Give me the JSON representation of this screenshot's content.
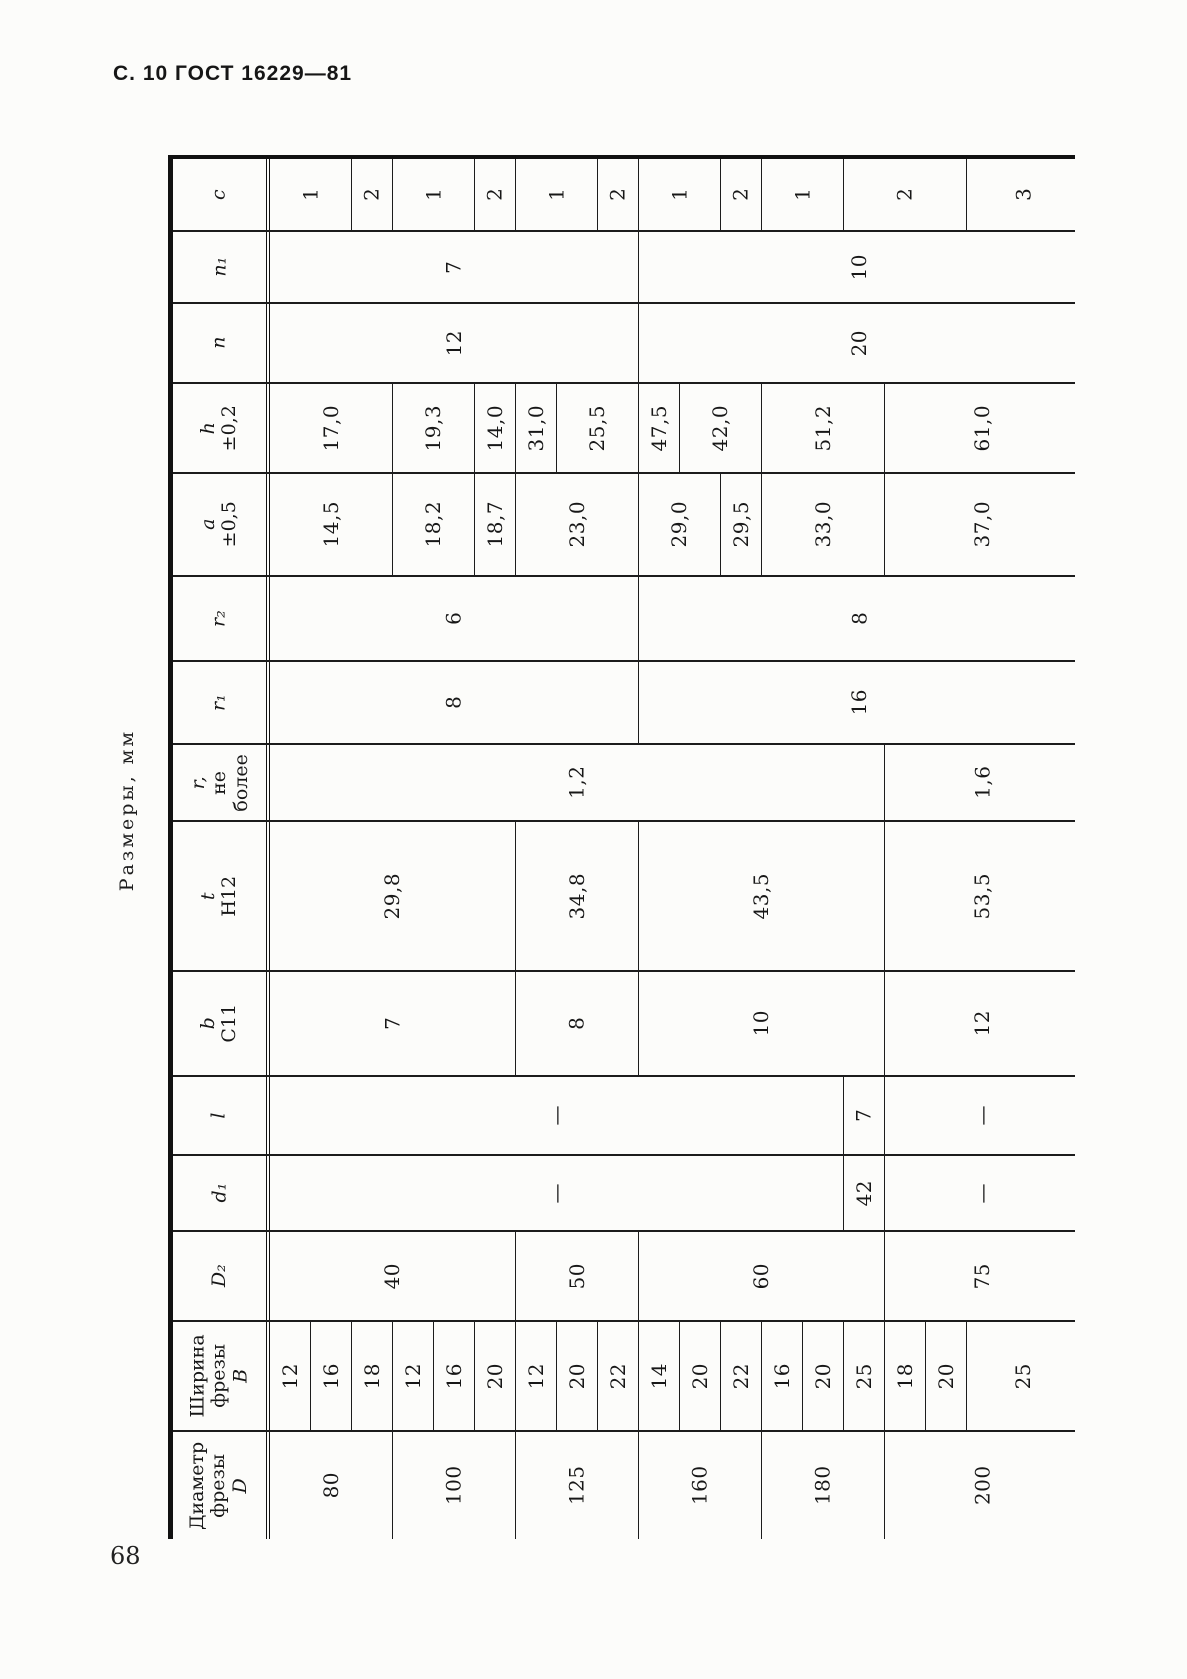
{
  "page": {
    "header": "С. 10 ГОСТ 16229—81",
    "page_number": "68",
    "table_caption": "Размеры, мм"
  },
  "table": {
    "columns": 18,
    "col_width": 41,
    "last_col_width": 113,
    "rows": [
      {
        "id": "c",
        "h": 73,
        "label": [
          {
            "t": "c",
            "i": true
          }
        ],
        "cells": [
          {
            "s": 2,
            "v": "1"
          },
          {
            "s": 1,
            "v": "2"
          },
          {
            "s": 2,
            "v": "1"
          },
          {
            "s": 1,
            "v": "2"
          },
          {
            "s": 2,
            "v": "1"
          },
          {
            "s": 1,
            "v": "2"
          },
          {
            "s": 2,
            "v": "1"
          },
          {
            "s": 1,
            "v": "2"
          },
          {
            "s": 2,
            "v": "1"
          },
          {
            "s": 3,
            "v": "2"
          },
          {
            "s": 1,
            "v": "3"
          }
        ]
      },
      {
        "id": "n1",
        "h": 72,
        "label": [
          {
            "t": "n₁",
            "i": true
          }
        ],
        "cells": [
          {
            "s": 9,
            "v": "7"
          },
          {
            "s": 9,
            "v": "10"
          }
        ]
      },
      {
        "id": "n",
        "h": 80,
        "label": [
          {
            "t": "n",
            "i": true
          }
        ],
        "cells": [
          {
            "s": 9,
            "v": "12"
          },
          {
            "s": 9,
            "v": "20"
          }
        ]
      },
      {
        "id": "h",
        "h": 90,
        "label": [
          {
            "t": "h",
            "i": true
          },
          {
            "t": "±0,2"
          }
        ],
        "cells": [
          {
            "s": 3,
            "v": "17,0"
          },
          {
            "s": 2,
            "v": "19,3"
          },
          {
            "s": 1,
            "v": "14,0"
          },
          {
            "s": 1,
            "v": "31,0"
          },
          {
            "s": 2,
            "v": "25,5"
          },
          {
            "s": 1,
            "v": "47,5"
          },
          {
            "s": 2,
            "v": "42,0"
          },
          {
            "s": 3,
            "v": "51,2"
          },
          {
            "s": 3,
            "v": "61,0"
          }
        ]
      },
      {
        "id": "a",
        "h": 103,
        "label": [
          {
            "t": "a",
            "i": true
          },
          {
            "t": "±0,5"
          }
        ],
        "cells": [
          {
            "s": 3,
            "v": "14,5"
          },
          {
            "s": 2,
            "v": "18,2"
          },
          {
            "s": 1,
            "v": "18,7"
          },
          {
            "s": 3,
            "v": "23,0"
          },
          {
            "s": 2,
            "v": "29,0"
          },
          {
            "s": 1,
            "v": "29,5"
          },
          {
            "s": 3,
            "v": "33,0"
          },
          {
            "s": 3,
            "v": "37,0"
          }
        ]
      },
      {
        "id": "r2",
        "h": 85,
        "label": [
          {
            "t": "r₂",
            "i": true
          }
        ],
        "cells": [
          {
            "s": 9,
            "v": "6"
          },
          {
            "s": 9,
            "v": "8"
          }
        ]
      },
      {
        "id": "r1",
        "h": 83,
        "label": [
          {
            "t": "r₁",
            "i": true
          }
        ],
        "cells": [
          {
            "s": 9,
            "v": "8"
          },
          {
            "s": 9,
            "v": "16"
          }
        ]
      },
      {
        "id": "r",
        "h": 77,
        "label": [
          {
            "t": "r,",
            "i": true
          },
          {
            "t": "не"
          },
          {
            "t": "более"
          }
        ],
        "cells": [
          {
            "s": 15,
            "v": "1,2"
          },
          {
            "s": 3,
            "v": "1,6"
          }
        ]
      },
      {
        "id": "t",
        "h": 150,
        "label": [
          {
            "t": "t",
            "i": true
          },
          {
            "t": "H12"
          }
        ],
        "cells": [
          {
            "s": 6,
            "v": "29,8"
          },
          {
            "s": 3,
            "v": "34,8"
          },
          {
            "s": 6,
            "v": "43,5"
          },
          {
            "s": 3,
            "v": "53,5"
          }
        ]
      },
      {
        "id": "b",
        "h": 105,
        "label": [
          {
            "t": "b",
            "i": true
          },
          {
            "t": "C11"
          }
        ],
        "cells": [
          {
            "s": 6,
            "v": "7"
          },
          {
            "s": 3,
            "v": "8"
          },
          {
            "s": 6,
            "v": "10"
          },
          {
            "s": 3,
            "v": "12"
          }
        ]
      },
      {
        "id": "l",
        "h": 79,
        "label": [
          {
            "t": "l",
            "i": true
          }
        ],
        "cells": [
          {
            "s": 14,
            "v": "—"
          },
          {
            "s": 1,
            "v": "7"
          },
          {
            "s": 3,
            "v": "—"
          }
        ]
      },
      {
        "id": "d1",
        "h": 76,
        "label": [
          {
            "t": "d₁",
            "i": true
          }
        ],
        "cells": [
          {
            "s": 14,
            "v": "—"
          },
          {
            "s": 1,
            "v": "42"
          },
          {
            "s": 3,
            "v": "—"
          }
        ]
      },
      {
        "id": "D2",
        "h": 90,
        "label": [
          {
            "t": "D₂",
            "i": true
          }
        ],
        "cells": [
          {
            "s": 6,
            "v": "40"
          },
          {
            "s": 3,
            "v": "50"
          },
          {
            "s": 6,
            "v": "60"
          },
          {
            "s": 3,
            "v": "75"
          }
        ]
      },
      {
        "id": "B",
        "h": 110,
        "label": [
          {
            "t": "Ширина"
          },
          {
            "t": "фрезы"
          },
          {
            "t": "B",
            "i": true
          }
        ],
        "cells": [
          {
            "s": 1,
            "v": "12"
          },
          {
            "s": 1,
            "v": "16"
          },
          {
            "s": 1,
            "v": "18"
          },
          {
            "s": 1,
            "v": "12"
          },
          {
            "s": 1,
            "v": "16"
          },
          {
            "s": 1,
            "v": "20"
          },
          {
            "s": 1,
            "v": "12"
          },
          {
            "s": 1,
            "v": "20"
          },
          {
            "s": 1,
            "v": "22"
          },
          {
            "s": 1,
            "v": "14"
          },
          {
            "s": 1,
            "v": "20"
          },
          {
            "s": 1,
            "v": "22"
          },
          {
            "s": 1,
            "v": "16"
          },
          {
            "s": 1,
            "v": "20"
          },
          {
            "s": 1,
            "v": "25"
          },
          {
            "s": 1,
            "v": "18"
          },
          {
            "s": 1,
            "v": "20"
          },
          {
            "s": 1,
            "v": "25"
          }
        ]
      },
      {
        "id": "D",
        "h": 107,
        "label": [
          {
            "t": "Диаметр"
          },
          {
            "t": "фрезы"
          },
          {
            "t": "D",
            "i": true
          }
        ],
        "cells": [
          {
            "s": 3,
            "v": "80"
          },
          {
            "s": 3,
            "v": "100"
          },
          {
            "s": 3,
            "v": "125"
          },
          {
            "s": 3,
            "v": "160"
          },
          {
            "s": 3,
            "v": "180"
          },
          {
            "s": 3,
            "v": "200"
          }
        ]
      }
    ]
  }
}
